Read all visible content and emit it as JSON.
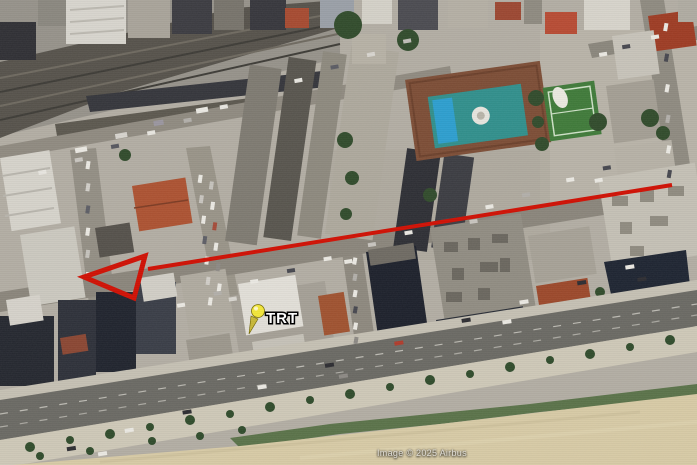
{
  "map": {
    "type": "satellite-imagery",
    "attribution": "Image © 2025 Airbus",
    "placemark": {
      "label": "TRT",
      "pin_color": "#f2e63c"
    },
    "arrow": {
      "color": "#d01408",
      "direction": "left"
    }
  }
}
